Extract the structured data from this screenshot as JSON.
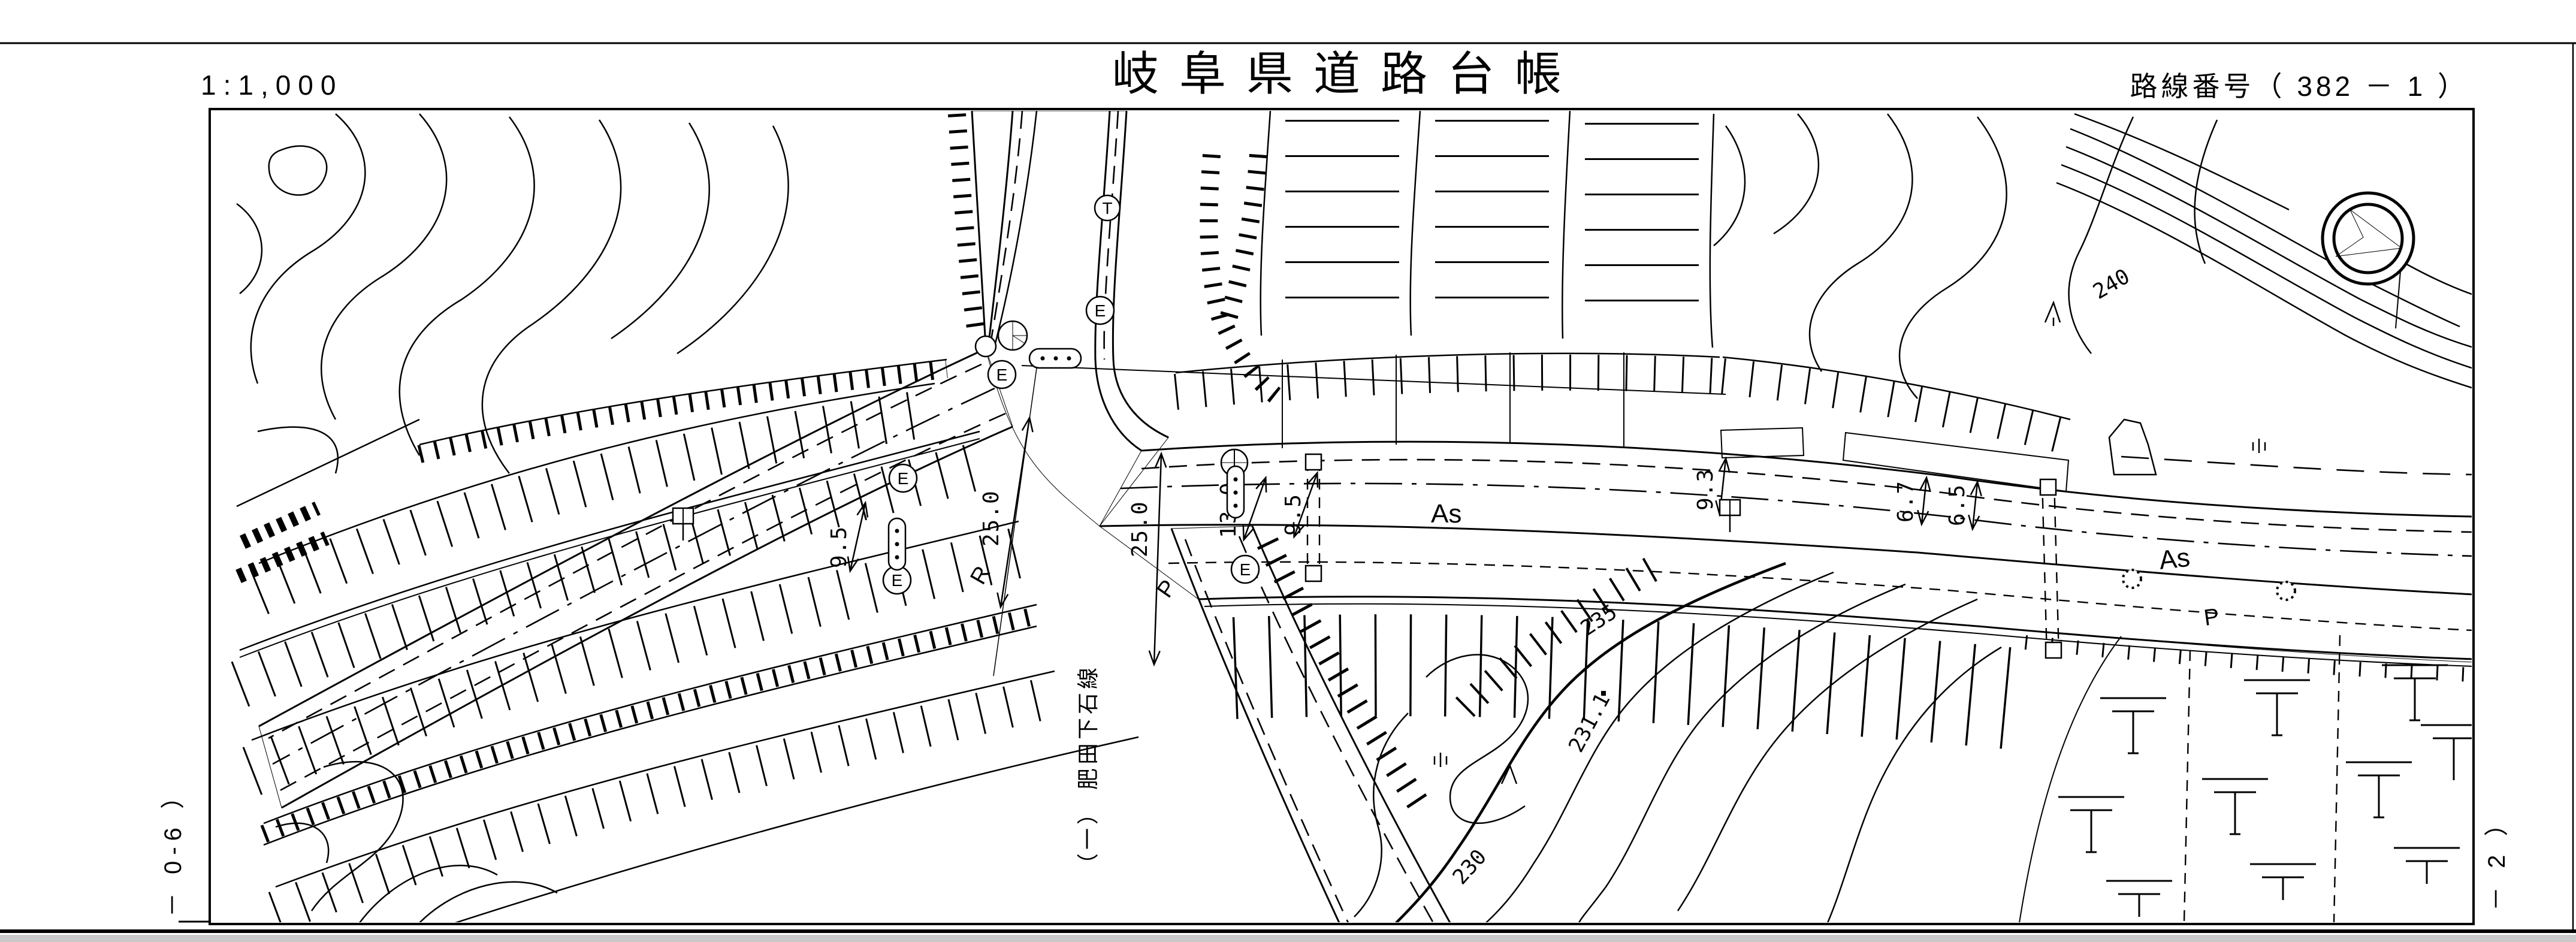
{
  "header": {
    "scale": "1:1,000",
    "title": "岐阜県道路台帳",
    "route_label": "路線番号（ 382 －  1  ）"
  },
  "margins": {
    "left": "－ 0-6 ）",
    "right": "－ 2 ）"
  },
  "map": {
    "road_name": "（一） 肥田下石線",
    "surface": {
      "as_left": "As",
      "as_right": "As",
      "p_left": "P",
      "p_right": "P",
      "r_left": "R"
    },
    "dimensions": {
      "d1": "9.5",
      "d2": "25.0",
      "d3": "25.0",
      "d4": "13.0",
      "d5": "9.5",
      "d6": "9.3",
      "d7": "6.7",
      "d8": "6.5"
    },
    "elevations": {
      "c240": "240",
      "c235": "235",
      "c231": "231.1",
      "c230": "230"
    },
    "markers": {
      "e": "E",
      "t": "T"
    }
  }
}
